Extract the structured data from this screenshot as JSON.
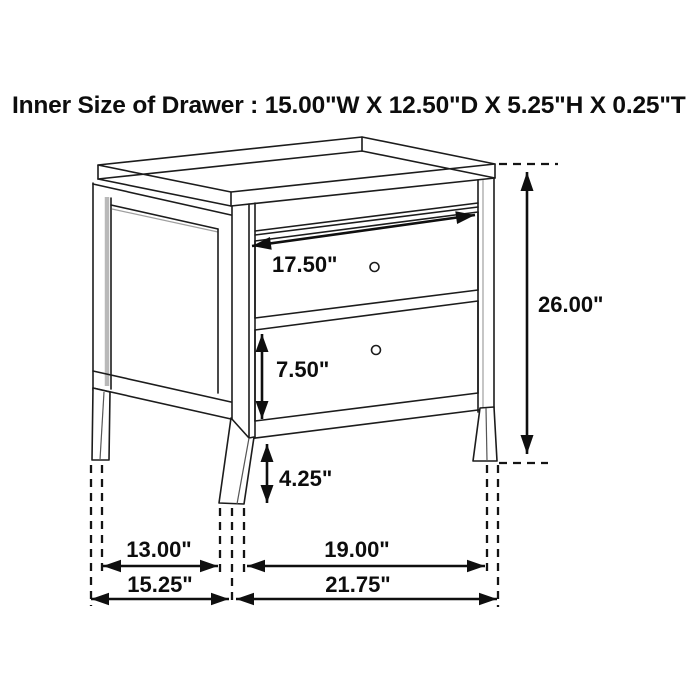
{
  "title": "Inner Size of Drawer : 15.00\"W X 12.50\"D X 5.25\"H X 0.25\"T",
  "dimensions": {
    "drawer_width": "17.50\"",
    "overall_height": "26.00\"",
    "bottom_drawer_height": "7.50\"",
    "leg_clearance": "4.25\"",
    "side_depth_inner": "13.00\"",
    "front_width_inner": "19.00\"",
    "side_depth_overall": "15.25\"",
    "front_width_overall": "21.75\""
  },
  "colors": {
    "background": "#ffffff",
    "line": "#1c1c1c",
    "dimension": "#0f0f0f",
    "secondary_line": "#b9b9b9",
    "text": "#0d0d0d"
  }
}
